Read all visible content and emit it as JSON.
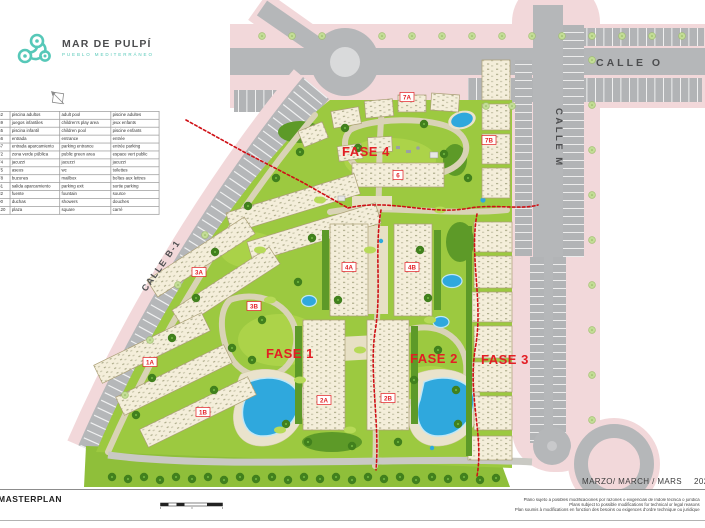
{
  "brand": {
    "name": "MAR DE PULPÍ",
    "tagline": "PUEBLO MEDITERRÁNEO"
  },
  "legend": {
    "rows": [
      {
        "num": "52",
        "es": "piscina adultos",
        "en": "adult pool",
        "fr": "piscine adultes"
      },
      {
        "num": "59",
        "es": "juegos infantiles",
        "en": "children's play area",
        "fr": "jeux enfants"
      },
      {
        "num": "65",
        "es": "piscina infantil",
        "en": "children pool",
        "fr": "piscine enfants"
      },
      {
        "num": "66",
        "es": "entrada",
        "en": "entrance",
        "fr": "entrée"
      },
      {
        "num": "67",
        "es": "entrada aparcamiento",
        "en": "parking entrance",
        "fr": "entrée parking"
      },
      {
        "num": "72",
        "es": "zona verde pública",
        "en": "public green area",
        "fr": "espace vert public"
      },
      {
        "num": "74",
        "es": "jacuzzi",
        "en": "jacuzzi",
        "fr": "jacuzzi"
      },
      {
        "num": "75",
        "es": "aseos",
        "en": "wc",
        "fr": "toilettes"
      },
      {
        "num": "78",
        "es": "buzones",
        "en": "mailbox",
        "fr": "boîtes aux lettres"
      },
      {
        "num": "81",
        "es": "salida aparcamiento",
        "en": "parking exit",
        "fr": "sortie parking"
      },
      {
        "num": "82",
        "es": "fuente",
        "en": "fountain",
        "fr": "source"
      },
      {
        "num": "90",
        "es": "duchas",
        "en": "showers",
        "fr": "douches"
      },
      {
        "num": "120",
        "es": "plaza",
        "en": "square",
        "fr": "carré"
      }
    ]
  },
  "map": {
    "streets": [
      {
        "label": "CALLE O"
      },
      {
        "label": "CALLE M"
      },
      {
        "label": "CALLE  B-1"
      }
    ],
    "phases": [
      {
        "label": "FASE 1"
      },
      {
        "label": "FASE 2"
      },
      {
        "label": "FASE 3"
      },
      {
        "label": "FASE 4"
      }
    ],
    "buildings": [
      {
        "label": "1A"
      },
      {
        "label": "1B"
      },
      {
        "label": "2A"
      },
      {
        "label": "2B"
      },
      {
        "label": "3A"
      },
      {
        "label": "3B"
      },
      {
        "label": "4A"
      },
      {
        "label": "4B"
      },
      {
        "label": "6"
      },
      {
        "label": "7A"
      },
      {
        "label": "7B"
      }
    ]
  },
  "footer": {
    "title": "MASTERPLAN",
    "date_line": "MARZO/ MARCH / MARS",
    "year": "2022",
    "disclaimer_es": "Plano sujeto a posibles modificaciones por razones o exigencias de índole técnica o jurídica",
    "disclaimer_en": "Plans subject to possible modifications for technical or legal reasons",
    "disclaimer_fr": "Plan soumis à modifications en fonction des besoins ou exigences d'ordre technique ou juridique"
  },
  "colors": {
    "accent_red": "#e31e24",
    "brand_teal": "#56c8b8",
    "pool_blue": "#2fa8dd",
    "lawn_green": "#9cc940",
    "sidewalk_pink": "#f2d8da",
    "road_gray": "#b5b7b9"
  }
}
